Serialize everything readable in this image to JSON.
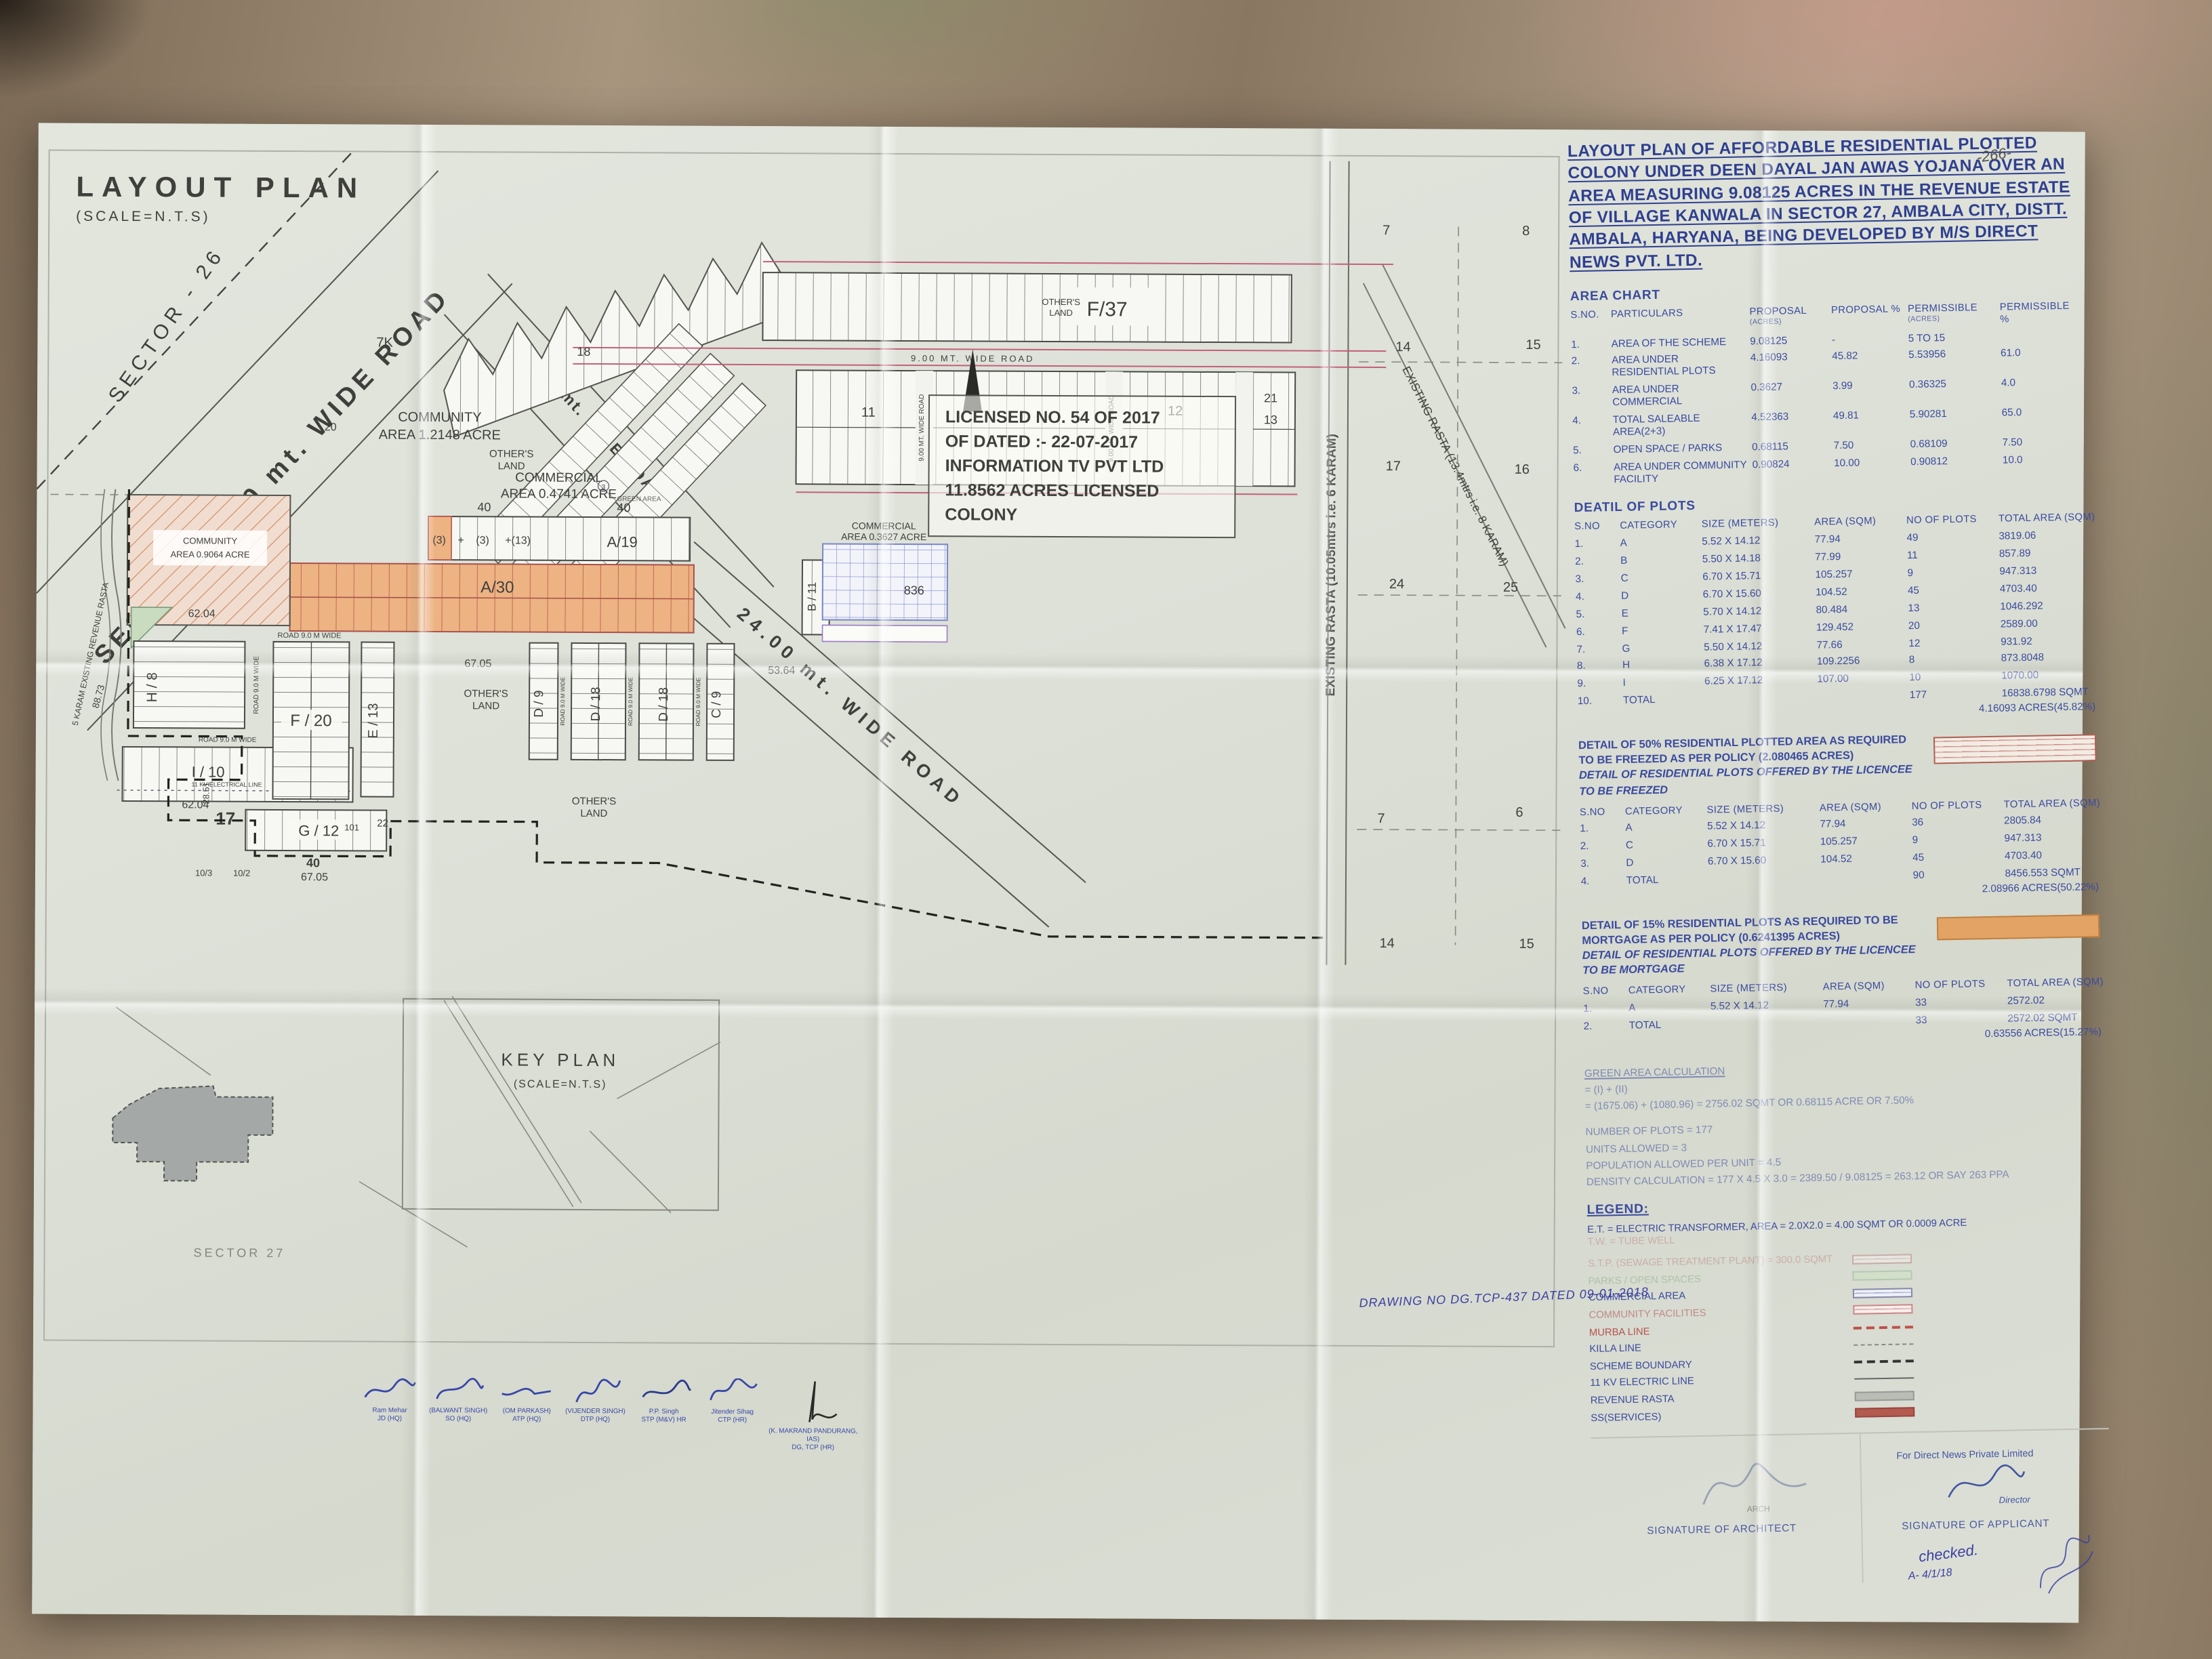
{
  "page_number": "-266-",
  "plan": {
    "title": "LAYOUT PLAN",
    "scale": "(SCALE=N.T.S)",
    "sector_26": "SECTOR - 26",
    "sector_road_45": "SECTOR 45.00 mt. WIDE ROAD",
    "road_24_upper": "24.00 mt. WIDE ROAD",
    "road_24_main": "24.00 mt. WIDE ROAD",
    "road_9_top": "9.00 MT. WIDE ROAD",
    "road_9_gap": "9.00 MT. WIDE ROAD",
    "road_9_wide": "ROAD 9.0 M WIDE",
    "rasta_6karam": "EXISTING RASTA (10.05mtrs i.e. 6 KARAM)",
    "rasta_8karam": "EXISTING RASTA (13.4mtrs i.e. 8 KARAM)",
    "revenue_rasta": "5 KARAM EXISTING REVENUE RASTA",
    "electric_11kv": "11 KV ELECTRICAL LINE",
    "license": {
      "l1": "LICENSED NO. 54 OF 2017",
      "l2": "OF DATED :- 22-07-2017",
      "l3": "INFORMATION TV PVT LTD",
      "l4": "11.8562 ACRES LICENSED",
      "l5": "COLONY"
    },
    "labels": {
      "f37": "F/37",
      "a19": "A/19",
      "a30": "A/30",
      "f20": "F / 20",
      "e13": "E / 13",
      "g12": "G / 12",
      "h8": "H / 8",
      "i10": "I / 10",
      "d9": "D / 9",
      "d18": "D / 18",
      "c9": "C / 9",
      "b11": "B / 11",
      "cell3a": "(3)",
      "plus": "+",
      "cell3b": "(3)",
      "cell13": "+(13)",
      "community_1a": "COMMUNITY",
      "community_1b": "AREA 1.2148 ACRE",
      "community_2a": "COMMUNITY",
      "community_2b": "AREA 0.9064 ACRE",
      "commercial_1a": "COMMERCIAL",
      "commercial_1b": "AREA 0.4741 ACRE",
      "commercial_2a": "COMMERCIAL",
      "commercial_2b": "AREA 0.3627 ACRE",
      "others_land_a": "OTHER'S",
      "others_land_b": "LAND",
      "green_area": "GREEN AREA",
      "c3": "3"
    },
    "nums": {
      "n7k": "7K",
      "n18": "18",
      "n20": "20",
      "n11": "11",
      "n12": "12",
      "n21": "21",
      "n13": "13",
      "n40": "40",
      "n836": "836",
      "n231": "23/1",
      "n232": "23/2",
      "n6204": "62.04",
      "n6705": "67.05",
      "n5364": "53.64",
      "n8873": "88.73",
      "n2851": "28.51",
      "n17": "17",
      "n103": "10/3",
      "n102": "10/2",
      "n101": "101",
      "n22": "22",
      "p7": "7",
      "p8": "8",
      "p14": "14",
      "p15": "15",
      "p16": "16",
      "p17": "17",
      "p24": "24",
      "p25": "25",
      "p6": "6"
    },
    "key_plan": {
      "title": "KEY PLAN",
      "scale": "(SCALE=N.T.S)",
      "sector_27": "SECTOR 27"
    }
  },
  "panel": {
    "title_lines": [
      "LAYOUT PLAN OF AFFORDABLE RESIDENTIAL PLOTTED",
      "COLONY UNDER DEEN DAYAL JAN AWAS YOJANA OVER AN",
      "AREA MEASURING 9.08125 ACRES IN THE REVENUE ESTATE",
      "OF VILLAGE KANWALA IN SECTOR 27, AMBALA CITY, DISTT.",
      "AMBALA, HARYANA, BEING DEVELOPED BY M/S DIRECT",
      "NEWS PVT. LTD."
    ],
    "area_chart": {
      "heading": "AREA CHART",
      "col_sno": "S.NO.",
      "col_part": "PARTICULARS",
      "col_prop": "PROPOSAL",
      "col_prop_sub": "(ACRES)",
      "col_prop_pct": "PROPOSAL %",
      "col_perm": "PERMISSIBLE",
      "col_perm_sub": "(ACRES)",
      "col_perm_pct": "PERMISSIBLE %",
      "rows": [
        {
          "sno": "1.",
          "part": "AREA OF THE SCHEME",
          "prop": "9.08125",
          "pct": "-",
          "perm": "5 TO 15",
          "ppct": ""
        },
        {
          "sno": "2.",
          "part": "AREA UNDER RESIDENTIAL PLOTS",
          "prop": "4.16093",
          "pct": "45.82",
          "perm": "5.53956",
          "ppct": "61.0"
        },
        {
          "sno": "3.",
          "part": "AREA UNDER COMMERCIAL",
          "prop": "0.3627",
          "pct": "3.99",
          "perm": "0.36325",
          "ppct": "4.0"
        },
        {
          "sno": "4.",
          "part": "TOTAL SALEABLE AREA(2+3)",
          "prop": "4.52363",
          "pct": "49.81",
          "perm": "5.90281",
          "ppct": "65.0"
        },
        {
          "sno": "5.",
          "part": "OPEN SPACE / PARKS",
          "prop": "0.68115",
          "pct": "7.50",
          "perm": "0.68109",
          "ppct": "7.50"
        },
        {
          "sno": "6.",
          "part": "AREA UNDER COMMUNITY FACILITY",
          "prop": "0.90824",
          "pct": "10.00",
          "perm": "0.90812",
          "ppct": "10.0"
        }
      ]
    },
    "plots": {
      "heading": "DEATIL OF PLOTS",
      "col_sno": "S.NO",
      "col_cat": "CATEGORY",
      "col_size": "SIZE (METERS)",
      "col_area": "AREA (SQM)",
      "col_no": "NO OF PLOTS",
      "col_total": "TOTAL AREA (SQM)",
      "rows": [
        [
          "1.",
          "A",
          "5.52 X 14.12",
          "77.94",
          "49",
          "3819.06"
        ],
        [
          "2.",
          "B",
          "5.50 X 14.18",
          "77.99",
          "11",
          "857.89"
        ],
        [
          "3.",
          "C",
          "6.70 X 15.71",
          "105.257",
          "9",
          "947.313"
        ],
        [
          "4.",
          "D",
          "6.70 X 15.60",
          "104.52",
          "45",
          "4703.40"
        ],
        [
          "5.",
          "E",
          "5.70 X 14.12",
          "80.484",
          "13",
          "1046.292"
        ],
        [
          "6.",
          "F",
          "7.41 X 17.47",
          "129.452",
          "20",
          "2589.00"
        ],
        [
          "7.",
          "G",
          "5.50 X 14.12",
          "77.66",
          "12",
          "931.92"
        ],
        [
          "8.",
          "H",
          "6.38 X 17.12",
          "109.2256",
          "8",
          "873.8048"
        ],
        [
          "9.",
          "I",
          "6.25 X 17.12",
          "107.00",
          "10",
          "1070.00"
        ]
      ],
      "total_sno": "10.",
      "total_label": "TOTAL",
      "total_plots": "177",
      "total_area": "16838.6798 SQMT",
      "total_acres": "4.16093 ACRES(45.82%)"
    },
    "freeze": {
      "h1": "DETAIL OF 50% RESIDENTIAL PLOTTED AREA AS REQUIRED",
      "h2": "TO BE FREEZED AS PER POLICY (2.080465 ACRES)",
      "h3": "DETAIL OF RESIDENTIAL PLOTS OFFERED BY THE LICENCEE TO BE FREEZED",
      "rows": [
        [
          "1.",
          "A",
          "5.52 X 14.12",
          "77.94",
          "36",
          "2805.84"
        ],
        [
          "2.",
          "C",
          "6.70 X 15.71",
          "105.257",
          "9",
          "947.313"
        ],
        [
          "3.",
          "D",
          "6.70 X 15.60",
          "104.52",
          "45",
          "4703.40"
        ]
      ],
      "total_sno": "4.",
      "total_label": "TOTAL",
      "total_plots": "90",
      "total_area": "8456.553 SQMT",
      "total_acres": "2.08966 ACRES(50.22%)"
    },
    "mortgage": {
      "h1": "DETAIL OF 15% RESIDENTIAL PLOTS AS REQUIRED TO BE",
      "h2": "MORTGAGE AS PER POLICY (0.6241395 ACRES)",
      "h3": "DETAIL OF RESIDENTIAL PLOTS OFFERED BY THE LICENCEE TO BE MORTGAGE",
      "rows": [
        [
          "1.",
          "A",
          "5.52 X 14.12",
          "77.94",
          "33",
          "2572.02"
        ]
      ],
      "total_sno": "2.",
      "total_label": "TOTAL",
      "total_plots": "33",
      "total_area": "2572.02 SQMT",
      "total_acres": "0.63556 ACRES(15.27%)"
    },
    "green_calc": {
      "l1": "GREEN AREA CALCULATION",
      "l2": "= (I) + (II)",
      "l3": "= (1675.06) + (1080.96) = 2756.02 SQMT OR 0.68115 ACRE OR 7.50%",
      "l4": "NUMBER OF PLOTS = 177",
      "l5": "UNITS ALLOWED = 3",
      "l6": "POPULATION ALLOWED PER UNIT = 4.5",
      "l7": "DENSITY CALCULATION = 177 X 4.5 X 3.0 = 2389.50 / 9.08125 = 263.12 OR SAY 263 PPA"
    },
    "legend": {
      "heading": "LEGEND:",
      "et_line": "E.T. = ELECTRIC TRANSFORMER, AREA = 2.0X2.0 = 4.00 SQMT OR 0.0009 ACRE",
      "tw_line": "T.W. = TUBE WELL",
      "items": [
        {
          "label": "S.T.P. (SEWAGE TREATMENT PLANT) = 300.0 SQMT"
        },
        {
          "label": "PARKS / OPEN SPACES"
        },
        {
          "label": "COMMERCIAL AREA"
        },
        {
          "label": "COMMUNITY FACILITIES"
        },
        {
          "label": "MURBA LINE"
        },
        {
          "label": "KILLA LINE"
        },
        {
          "label": "SCHEME BOUNDARY"
        },
        {
          "label": "11 KV ELECTRIC LINE"
        },
        {
          "label": "REVENUE RASTA"
        },
        {
          "label": "SS(SERVICES)"
        }
      ]
    },
    "drawing_no": "DRAWING NO DG.TCP-437 DATED 09-01-2018",
    "signatures": {
      "company": "For Direct News Private Limited",
      "director": "Director",
      "architect_label": "SIGNATURE OF ARCHITECT",
      "applicant_label": "SIGNATURE OF APPLICANT",
      "arch_stamp": "ARCH",
      "checked": "checked.",
      "date_note": "A- 4/1/18"
    },
    "stamps": [
      {
        "name": "Ram Mehar",
        "dept": "JD (HQ)"
      },
      {
        "name": "(BALWANT SINGH)",
        "dept": "SO (HQ)"
      },
      {
        "name": "(OM PARKASH)",
        "dept": "ATP (HQ)"
      },
      {
        "name": "(VIJENDER SINGH)",
        "dept": "DTP (HQ)"
      },
      {
        "name": "P.P. Singh",
        "dept": "STP (M&V) HR"
      },
      {
        "name": "Jitender Sihag",
        "dept": "CTP (HR)"
      },
      {
        "name": "(K. MAKRAND PANDURANG, IAS)",
        "dept": "DG, TCP (HR)"
      }
    ]
  }
}
